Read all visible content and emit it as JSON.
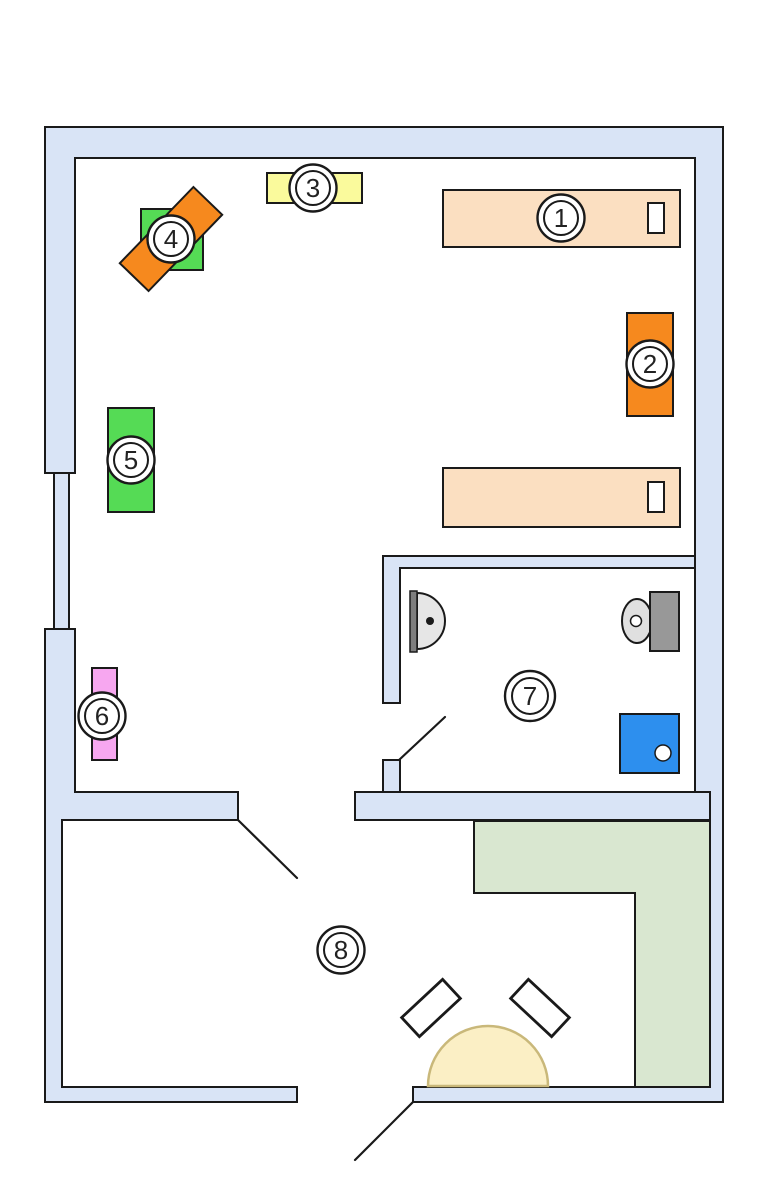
{
  "page": {
    "background": "#ffffff"
  },
  "colors": {
    "wall": "#d9e4f6",
    "window": "#d9e4f6",
    "outline": "#1a1a1a",
    "bed": "#fbdfc1",
    "pillow": "#ffffff",
    "cabinet_orange": "#f6891e",
    "shelf_yellow": "#fafa9c",
    "green": "#55db55",
    "pink": "#f7a7f0",
    "counter_green": "#d9e7d0",
    "shower_blue": "#2d8fee",
    "tank_gray": "#989898",
    "sink_gray": "#e6e6e6",
    "sink_bar": "#7e7e7e",
    "toilet_bowl": "#e0e0e0",
    "drain_white": "#ffffff",
    "table_fill": "#fbefc5",
    "table_edge": "#c9b87a",
    "marker_fill": "#ffffff",
    "dot_black": "#1a1a1a"
  },
  "markers": [
    {
      "label": "1"
    },
    {
      "label": "2"
    },
    {
      "label": "3"
    },
    {
      "label": "4"
    },
    {
      "label": "5"
    },
    {
      "label": "6"
    },
    {
      "label": "7"
    },
    {
      "label": "8"
    }
  ]
}
